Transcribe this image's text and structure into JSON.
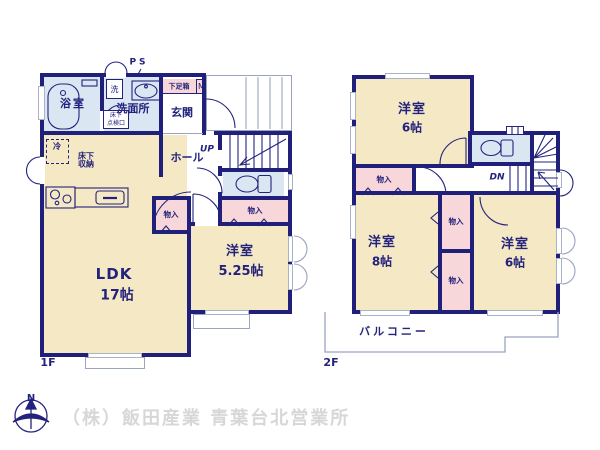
{
  "floor1": {
    "name": "1F",
    "bath": "浴室",
    "washer": "洗",
    "washroom": "洗面所",
    "ps": "PS",
    "shoebox": "下足箱",
    "meter": "M",
    "entrance": "玄関",
    "hall": "ホール",
    "up": "UP",
    "fridge": "冷",
    "underfloor_storage_line1": "床下",
    "underfloor_storage_line2": "収納",
    "access_hatch_line1": "床下",
    "access_hatch_line2": "点検口",
    "closet_west": "物入",
    "closet_hall": "物入",
    "bedroom": {
      "name": "洋室",
      "size": "5.25帖"
    },
    "ldk": {
      "name": "LDK",
      "size": "17帖"
    }
  },
  "floor2": {
    "name": "2F",
    "bedroom_north": {
      "name": "洋室",
      "size": "6帖"
    },
    "closet_north": "物入",
    "down": "DN",
    "bedroom_west": {
      "name": "洋室",
      "size": "8帖"
    },
    "closet_mid_upper": "物入",
    "closet_mid_lower": "物入",
    "bedroom_east": {
      "name": "洋室",
      "size": "6帖"
    },
    "balcony": "バルコニー"
  },
  "footer": {
    "compass_north": "N",
    "company": "（株）飯田産業 青葉台北営業所"
  },
  "colors": {
    "wall": "#20207b",
    "room": "#f5e8c4",
    "closet": "#f8d7da",
    "wet": "#dae7f3",
    "text": "#23237d",
    "outline": "#9aa4c0",
    "footer_text": "#d7d7d7"
  }
}
